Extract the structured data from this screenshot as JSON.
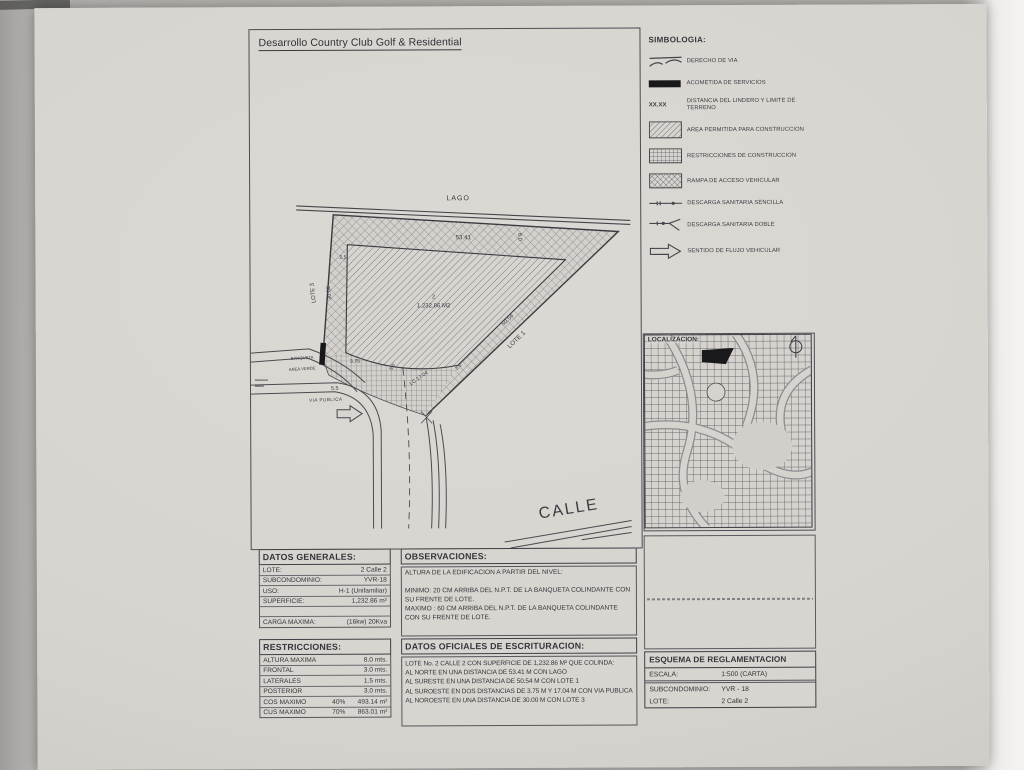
{
  "title": "Desarrollo Country Club Golf & Residential",
  "plan": {
    "lago_label": "LAGO",
    "dim_north": "53.41",
    "dim_offset_right": "6.0",
    "dim_offset_left": "2.5",
    "lote3_label": "LOTE 3",
    "dim_northwest": "30.00",
    "lot_number": "2",
    "lot_area": "1,232.86 M2",
    "dim_southeast": "50.54",
    "lote1_label": "LOTE 1",
    "dim_front_short": "3.75",
    "dim_front_inner": "5.0",
    "dim_front_curve": "LC 17.04",
    "dim_inner_corner": "2.5",
    "dim_street": "5.5",
    "banqueta_label": "BANQUETA",
    "area_verde_label": "AREA VERDE",
    "via_publica_label": "VIA PUBLICA",
    "calle_label": "CALLE"
  },
  "simbologia": {
    "title": "SIMBOLOGIA:",
    "items": [
      {
        "symbol": "derecho-de-via",
        "label": "DERECHO DE VIA"
      },
      {
        "symbol": "acometida-de-servicios",
        "label": "ACOMETIDA DE SERVICIOS"
      },
      {
        "symbol": "distancia-lindero",
        "code": "XX.XX",
        "label": "DISTANCIA DEL LINDERO Y LIMITE DE TERRENO"
      },
      {
        "symbol": "area-permitida",
        "label": "AREA PERMITIDA PARA CONSTRUCCION"
      },
      {
        "symbol": "restricciones-construccion",
        "label": "RESTRICCIONES DE CONSTRUCCION"
      },
      {
        "symbol": "rampa-acceso",
        "label": "RAMPA DE ACCESO VEHICULAR"
      },
      {
        "symbol": "descarga-sencilla",
        "label": "DESCARGA SANITARIA SENCILLA"
      },
      {
        "symbol": "descarga-doble",
        "label": "DESCARGA SANITARIA DOBLE"
      },
      {
        "symbol": "sentido-flujo",
        "label": "SENTIDO DE FLUJO VEHICULAR"
      }
    ]
  },
  "localizacion": {
    "title": "LOCALIZACION:"
  },
  "datos_generales": {
    "title": "DATOS GENERALES:",
    "rows": [
      {
        "label": "LOTE:",
        "value": "2 Calle 2"
      },
      {
        "label": "SUBCONDOMINIO:",
        "value": "YVR-18"
      },
      {
        "label": "USO:",
        "value": "H-1 (Unifamiliar)"
      },
      {
        "label": "SUPERFICIE:",
        "value": "1,232.86 m²"
      }
    ],
    "carga": {
      "label": "CARGA MAXIMA:",
      "value": "(16kw) 20Kva"
    }
  },
  "restricciones": {
    "title": "RESTRICCIONES:",
    "rows": [
      {
        "label": "ALTURA MAXIMA",
        "pct": "",
        "value": "8.0 mts."
      },
      {
        "label": "FRONTAL",
        "pct": "",
        "value": "3.0 mts."
      },
      {
        "label": "LATERALES",
        "pct": "",
        "value": "1.5 mts."
      },
      {
        "label": "POSTERIOR",
        "pct": "",
        "value": "3.0 mts."
      },
      {
        "label": "COS MAXIMO",
        "pct": "40%",
        "value": "493.14 m²"
      },
      {
        "label": "CUS MAXIMO",
        "pct": "70%",
        "value": "863.01 m²"
      }
    ]
  },
  "observaciones": {
    "title": "OBSERVACIONES:",
    "intro": "ALTURA DE LA EDIFICACION A PARTIR DEL NIVEL:",
    "minimo": "MINIMO: 20 CM ARRIBA DEL N.P.T. DE LA BANQUETA COLINDANTE CON SU FRENTE DE LOTE.",
    "maximo": "MAXIMO : 60 CM ARRIBA DEL N.P.T. DE LA BANQUETA COLINDANTE CON SU FRENTE DE LOTE."
  },
  "escrituracion": {
    "title": "DATOS OFICIALES DE ESCRITURACION:",
    "lines": [
      "LOTE No. 2 CALLE 2 CON SUPERFICIE DE 1,232.86 M² QUE COLINDA:",
      "AL NORTE  EN UNA DISTANCIA DE 53.41 M CON LAGO",
      "AL SURESTE  EN UNA DISTANCIA DE 50.54 M CON LOTE 1",
      "AL SUROESTE EN DOS DISTANCIAS DE 3.75 M Y 17.04 M CON VIA PUBLICA",
      "AL NOROESTE  EN UNA DISTANCIA DE 30.00 M CON LOTE 3"
    ]
  },
  "esquema": {
    "title": "ESQUEMA DE REGLAMENTACION",
    "rows": [
      {
        "label": "ESCALA:",
        "value": "1:500 (CARTA)"
      },
      {
        "label": "SUBCONDOMINIO:",
        "value": "YVR - 18"
      },
      {
        "label": "LOTE:",
        "value": "2 Calle 2"
      }
    ]
  },
  "colors": {
    "paper": "#d8d5d0",
    "ink": "#3a3a40",
    "marker_black": "#18181a"
  }
}
